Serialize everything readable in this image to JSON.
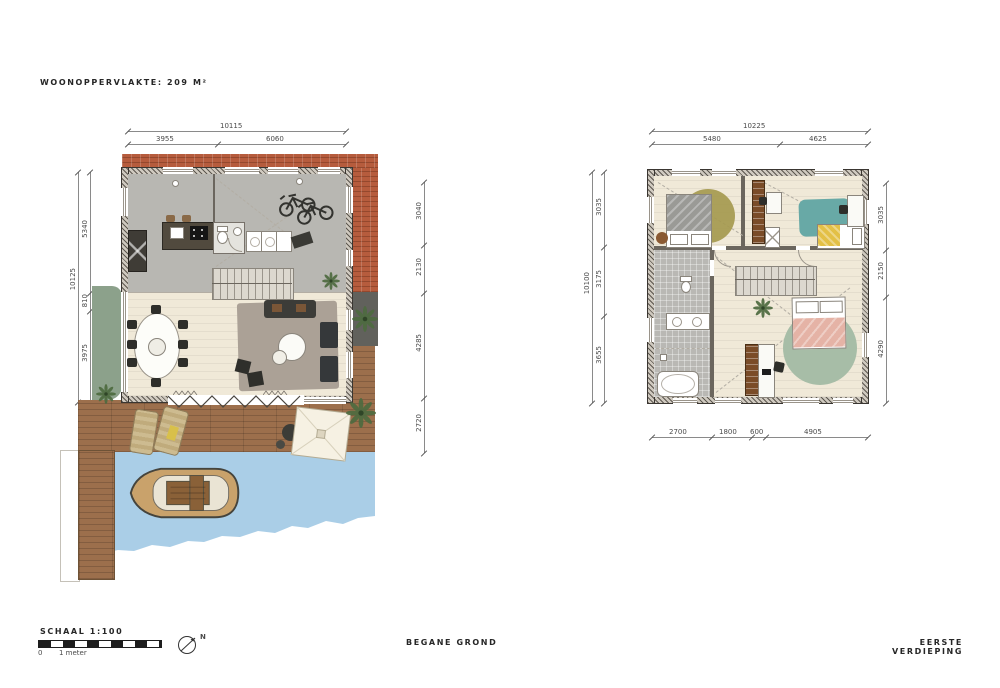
{
  "title": "WOONOPPERVLAKTE: 209 M²",
  "plans": {
    "ground": {
      "caption": "BEGANE GROND",
      "dims": {
        "top_total": "10115",
        "top_segments": [
          "3955",
          "6060"
        ],
        "left_total": "10125",
        "left_segments": [
          "5340",
          "810",
          "3975"
        ],
        "right_segments": [
          "3040",
          "2130",
          "4285",
          "2720"
        ]
      }
    },
    "first": {
      "caption": "EERSTE VERDIEPING",
      "dims": {
        "top_total": "10225",
        "top_segments": [
          "5480",
          "4625"
        ],
        "left_total": "10100",
        "left_segments": [
          "3035",
          "3175",
          "3655"
        ],
        "right_segments": [
          "3035",
          "2150",
          "4290"
        ],
        "bottom_segments": [
          "2700",
          "1800",
          "600",
          "4905"
        ]
      }
    }
  },
  "scale": {
    "label": "SCHAAL 1:100",
    "tick_zero": "0",
    "tick_one": "1 meter"
  },
  "north_label": "N",
  "colors": {
    "brick": "#b65c3d",
    "concrete_floor": "#b8b7b2",
    "wood_floor": "#f0e9d8",
    "deck_wood": "#9c6f4c",
    "water": "#aacee7",
    "grass": "#8ca18b",
    "tile_gray": "#b9b8b4",
    "rug_gray": "#aba196",
    "rug_sage": "#a7bda7",
    "rug_teal": "#68a9a6",
    "rug_olive": "#a5994f",
    "blanket_pink": "#e5b3a6",
    "blanket_yellow": "#e3c046",
    "blanket_gray": "#9a9a96",
    "furniture_dark": "#3c3c38",
    "wardrobe_brown": "#7a4c28",
    "pavement": "#61615c"
  }
}
